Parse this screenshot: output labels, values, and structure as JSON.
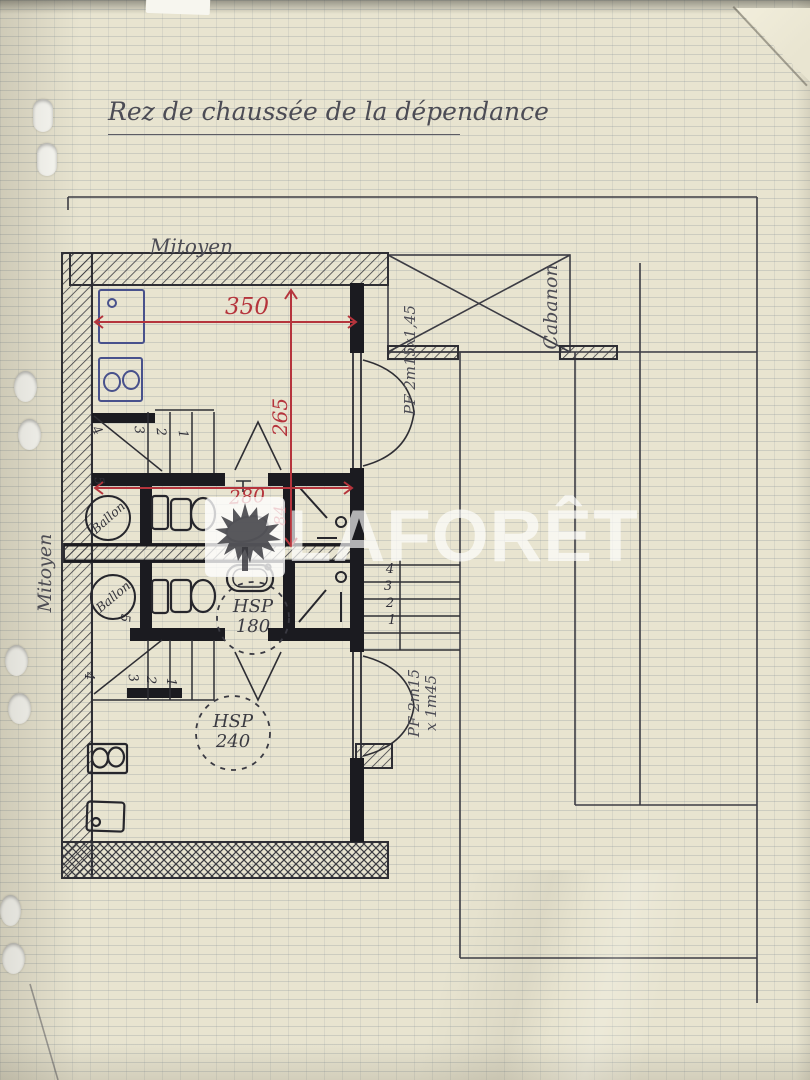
{
  "page": {
    "title": "Rez de chaussée de la dépendance"
  },
  "watermark": {
    "brand": "LAFORÊT"
  },
  "plan": {
    "labels": {
      "mitoyen_top": "Mitoyen",
      "mitoyen_left": "Mitoyen",
      "cabanon": "Cabanon",
      "pf_upper": "PF 2m15x1,45",
      "pf_lower_l1": "PF 2m15",
      "pf_lower_l2": "x 1m45",
      "hsp1_l1": "HSP",
      "hsp1_l2": "180",
      "hsp2_l1": "HSP",
      "hsp2_l2": "240",
      "ballon_upper": "Ballon",
      "ballon_lower": "Ballon"
    },
    "dimensions": {
      "width_350": "350",
      "depth_265": "265",
      "width_280": "280",
      "height_84": "84"
    },
    "stair_numbers": {
      "upper_left": [
        "3",
        "2",
        "1",
        "4",
        "5"
      ],
      "lower_left": [
        "5",
        "4",
        "3",
        "2",
        "1"
      ],
      "right": [
        "4",
        "3",
        "2",
        "1"
      ]
    },
    "colors": {
      "red_ink": "#b5343c",
      "blue_ink": "#48518c",
      "black_ink": "#2e2e34",
      "paper": "#e8e4d0"
    }
  }
}
